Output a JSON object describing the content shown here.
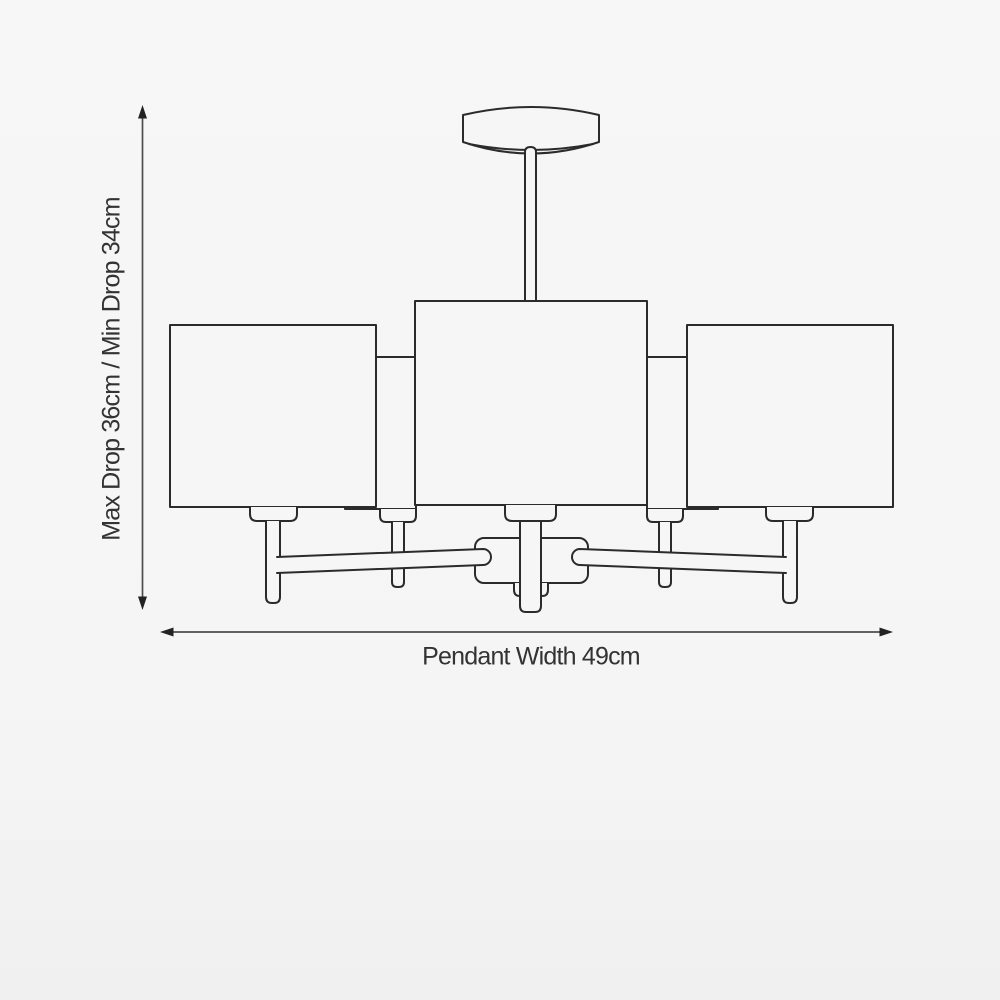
{
  "page": {
    "figure_alt": "Technical line drawing of a five-arm ceiling pendant light with rectangular box shades, a round ceiling rose, central drop rod, candle stems and radiating arms joined at a central hub",
    "background_color": "#f5f5f6"
  },
  "dimension_labels": {
    "drop": "Max Drop 36cm / Min Drop 34cm",
    "width": "Pendant Width 49cm"
  },
  "dimensions": {
    "max_drop": "36cm",
    "min_drop": "34cm",
    "pendant_width": "49cm"
  },
  "style": {
    "line_color": "#2b2b2b",
    "dimension_line_color": "#4d4d4d",
    "text_color": "#333333"
  }
}
